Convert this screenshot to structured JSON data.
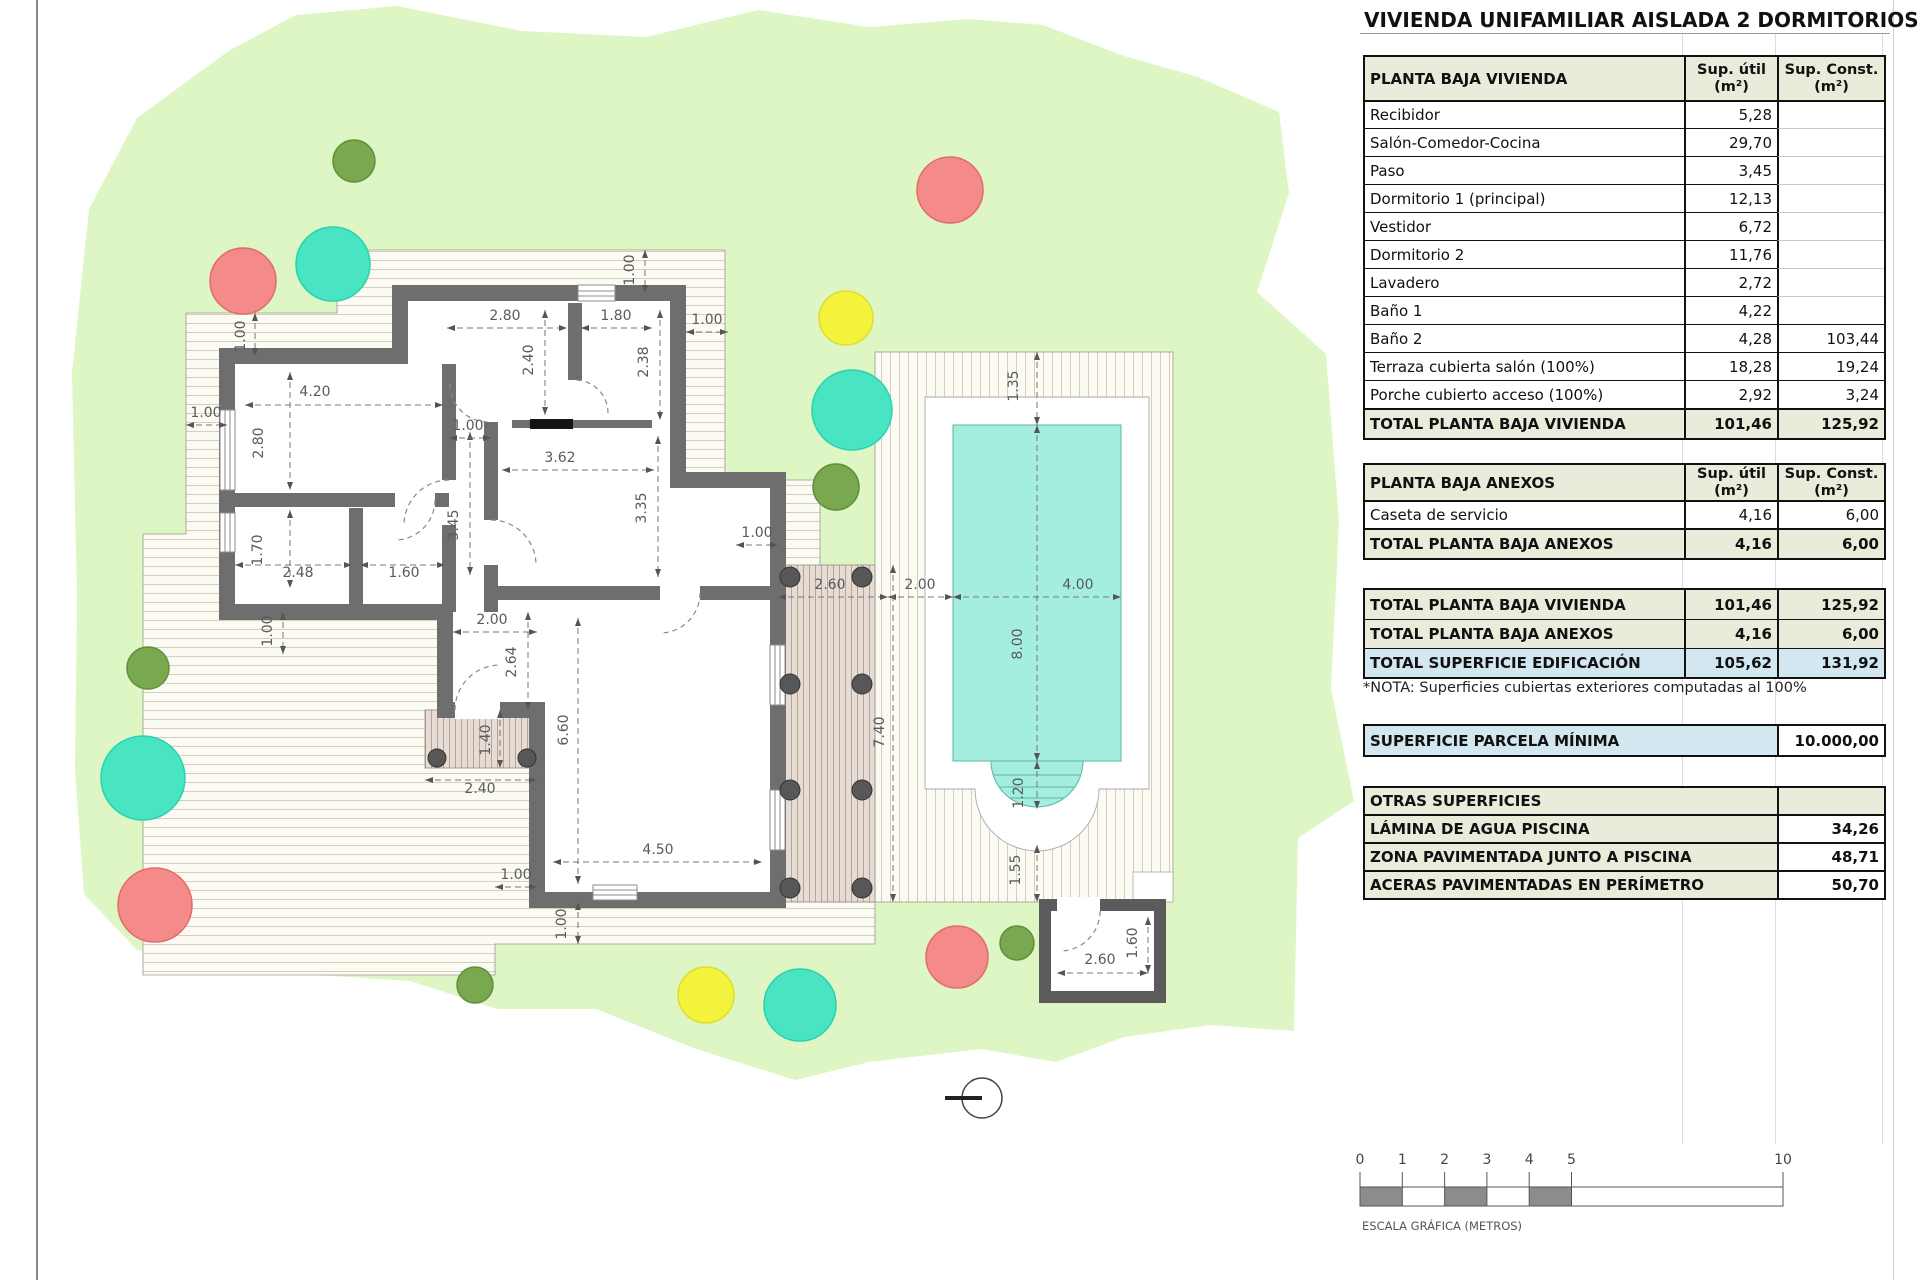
{
  "title": "VIVIENDA UNIFAMILIAR AISLADA 2 DORMITORIOS",
  "tables": {
    "vivienda": {
      "headers": [
        "PLANTA BAJA VIVIENDA",
        "Sup. útil\n(m²)",
        "Sup. Const.\n(m²)"
      ],
      "rows": [
        [
          "Recibidor",
          "5,28",
          ""
        ],
        [
          "Salón-Comedor-Cocina",
          "29,70",
          ""
        ],
        [
          "Paso",
          "3,45",
          ""
        ],
        [
          "Dormitorio 1 (principal)",
          "12,13",
          ""
        ],
        [
          "Vestidor",
          "6,72",
          ""
        ],
        [
          "Dormitorio 2",
          "11,76",
          ""
        ],
        [
          "Lavadero",
          "2,72",
          ""
        ],
        [
          "Baño 1",
          "4,22",
          ""
        ],
        [
          "Baño 2",
          "4,28",
          "103,44"
        ],
        [
          "Terraza cubierta salón (100%)",
          "18,28",
          "19,24"
        ],
        [
          "Porche cubierto acceso (100%)",
          "2,92",
          "3,24"
        ]
      ],
      "total": [
        "TOTAL PLANTA BAJA VIVIENDA",
        "101,46",
        "125,92"
      ]
    },
    "anexos": {
      "headers": [
        "PLANTA BAJA ANEXOS",
        "Sup. útil\n(m²)",
        "Sup. Const.\n(m²)"
      ],
      "rows": [
        [
          "Caseta de servicio",
          "4,16",
          "6,00"
        ]
      ],
      "total": [
        "TOTAL PLANTA BAJA ANEXOS",
        "4,16",
        "6,00"
      ]
    },
    "summary": {
      "rows": [
        [
          "TOTAL PLANTA BAJA VIVIENDA",
          "101,46",
          "125,92"
        ],
        [
          "TOTAL PLANTA BAJA ANEXOS",
          "4,16",
          "6,00"
        ],
        [
          "TOTAL SUPERFICIE EDIFICACIÓN",
          "105,62",
          "131,92"
        ]
      ]
    },
    "nota": "*NOTA: Superficies cubiertas exteriores computadas al 100%",
    "parcela": {
      "label": "SUPERFICIE PARCELA MÍNIMA",
      "value": "10.000,00"
    },
    "otras": {
      "header": "OTRAS SUPERFICIES",
      "rows": [
        [
          "LÁMINA DE AGUA PISCINA",
          "34,26"
        ],
        [
          "ZONA PAVIMENTADA JUNTO A PISCINA",
          "48,71"
        ],
        [
          "ACERAS PAVIMENTADAS EN PERÍMETRO",
          "50,70"
        ]
      ]
    }
  },
  "scalebar": {
    "ticks": [
      0,
      1,
      2,
      3,
      4,
      5,
      10
    ],
    "label": "ESCALA GRÁFICA (METROS)",
    "meters_to_px": 42.3,
    "origin_x": 1360
  },
  "plan": {
    "colors": {
      "parcel": "#ddf6c4",
      "wall": "#6e6e6e",
      "water": "#a4eede",
      "water_line": "#5fb3a4",
      "red": "#f58a8a",
      "red_s": "#e26b6b",
      "teal": "#49e5c3",
      "teal_s": "#2bd1ad",
      "yellow": "#f3f23c",
      "yellow_s": "#e0dd2a",
      "green": "#79a851",
      "green_s": "#5f8f3c",
      "dim": "#5a5a5a"
    },
    "trees": [
      {
        "x": 354,
        "y": 161,
        "r": 21,
        "c": "green"
      },
      {
        "x": 950,
        "y": 190,
        "r": 33,
        "c": "red"
      },
      {
        "x": 243,
        "y": 281,
        "r": 33,
        "c": "red"
      },
      {
        "x": 333,
        "y": 264,
        "r": 37,
        "c": "teal"
      },
      {
        "x": 846,
        "y": 318,
        "r": 27,
        "c": "yellow"
      },
      {
        "x": 852,
        "y": 410,
        "r": 40,
        "c": "teal"
      },
      {
        "x": 836,
        "y": 487,
        "r": 23,
        "c": "green"
      },
      {
        "x": 148,
        "y": 668,
        "r": 21,
        "c": "green"
      },
      {
        "x": 143,
        "y": 778,
        "r": 42,
        "c": "teal"
      },
      {
        "x": 155,
        "y": 905,
        "r": 37,
        "c": "red"
      },
      {
        "x": 475,
        "y": 985,
        "r": 18,
        "c": "green"
      },
      {
        "x": 706,
        "y": 995,
        "r": 28,
        "c": "yellow"
      },
      {
        "x": 800,
        "y": 1005,
        "r": 36,
        "c": "teal"
      },
      {
        "x": 957,
        "y": 957,
        "r": 31,
        "c": "red"
      },
      {
        "x": 1017,
        "y": 943,
        "r": 17,
        "c": "green"
      }
    ],
    "dim_labels": [
      {
        "t": "4.20",
        "x": 315,
        "y": 396,
        "r": 0
      },
      {
        "t": "2.80",
        "x": 263,
        "y": 443,
        "r": 90
      },
      {
        "t": "1.70",
        "x": 262,
        "y": 550,
        "r": 90
      },
      {
        "t": "2.48",
        "x": 298,
        "y": 577,
        "r": 0
      },
      {
        "t": "1.60",
        "x": 404,
        "y": 577,
        "r": 0
      },
      {
        "t": "2.80",
        "x": 505,
        "y": 320,
        "r": 0
      },
      {
        "t": "1.80",
        "x": 616,
        "y": 320,
        "r": 0
      },
      {
        "t": "2.40",
        "x": 533,
        "y": 360,
        "r": 90
      },
      {
        "t": "2.38",
        "x": 648,
        "y": 362,
        "r": 90
      },
      {
        "t": "3.62",
        "x": 560,
        "y": 462,
        "r": 0
      },
      {
        "t": "3.35",
        "x": 646,
        "y": 508,
        "r": 90
      },
      {
        "t": "3.45",
        "x": 458,
        "y": 525,
        "r": 90
      },
      {
        "t": "6.60",
        "x": 568,
        "y": 730,
        "r": 90
      },
      {
        "t": "4.50",
        "x": 658,
        "y": 854,
        "r": 0
      },
      {
        "t": "2.00",
        "x": 492,
        "y": 624,
        "r": 0
      },
      {
        "t": "2.64",
        "x": 516,
        "y": 662,
        "r": 90
      },
      {
        "t": "1.40",
        "x": 490,
        "y": 740,
        "r": 90
      },
      {
        "t": "2.40",
        "x": 480,
        "y": 793,
        "r": 0
      },
      {
        "t": "1.00",
        "x": 245,
        "y": 336,
        "r": 90
      },
      {
        "t": "1.00",
        "x": 206,
        "y": 417,
        "r": 0
      },
      {
        "t": "1.00",
        "x": 272,
        "y": 631,
        "r": 90
      },
      {
        "t": "1.00",
        "x": 634,
        "y": 270,
        "r": 90
      },
      {
        "t": "1.00",
        "x": 707,
        "y": 324,
        "r": 0
      },
      {
        "t": "1.00",
        "x": 757,
        "y": 537,
        "r": 0
      },
      {
        "t": "1.00",
        "x": 516,
        "y": 879,
        "r": 0
      },
      {
        "t": "1.00",
        "x": 566,
        "y": 924,
        "r": 90
      },
      {
        "t": "1.00",
        "x": 468,
        "y": 430,
        "r": 0
      },
      {
        "t": "2.60",
        "x": 830,
        "y": 589,
        "r": 0
      },
      {
        "t": "2.00",
        "x": 920,
        "y": 589,
        "r": 0
      },
      {
        "t": "4.00",
        "x": 1078,
        "y": 589,
        "r": 0
      },
      {
        "t": "8.00",
        "x": 1022,
        "y": 644,
        "r": 90
      },
      {
        "t": "1.35",
        "x": 1018,
        "y": 386,
        "r": 90
      },
      {
        "t": "7.40",
        "x": 884,
        "y": 732,
        "r": 90
      },
      {
        "t": "1.20",
        "x": 1023,
        "y": 793,
        "r": 90
      },
      {
        "t": "1.55",
        "x": 1020,
        "y": 870,
        "r": 90
      },
      {
        "t": "2.60",
        "x": 1100,
        "y": 964,
        "r": 0
      },
      {
        "t": "1.60",
        "x": 1137,
        "y": 943,
        "r": 90
      }
    ]
  }
}
